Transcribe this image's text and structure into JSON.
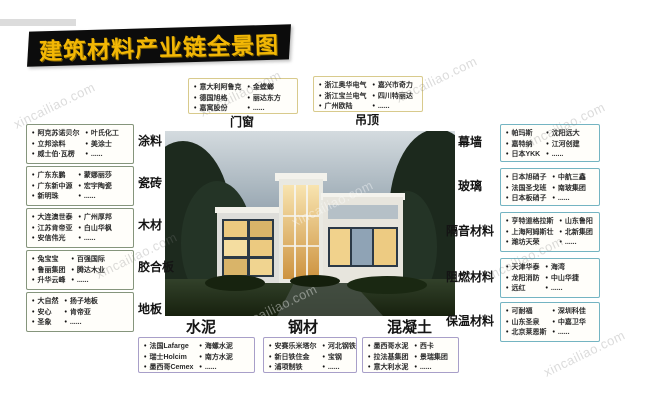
{
  "page": {
    "title": "建筑材料产业链全景图",
    "watermark": "xincailiao.com",
    "colors": {
      "banner_bg": "#0c0c0c",
      "banner_text": "#f2b705",
      "border_top_boxes": "#d8ca8c",
      "border_left_boxes": "#85957c",
      "border_right_boxes": "#74b4c2",
      "border_bottom_boxes": "#a89fc9"
    }
  },
  "boxes": [
    {
      "id": "menchuang",
      "label": "门窗",
      "col1": [
        "意大利阿鲁克",
        "德国旭格",
        "嘉寓股份"
      ],
      "col2": [
        "金螳螂",
        "丽达东方",
        "......"
      ]
    },
    {
      "id": "diaoding",
      "label": "吊顶",
      "col1": [
        "浙江奥华电气",
        "浙江宝兰电气",
        "广州欧陆"
      ],
      "col2": [
        "嘉兴市奇力",
        "四川特丽达",
        "......"
      ]
    },
    {
      "id": "tuliao",
      "label": "涂料",
      "col1": [
        "阿克苏诺贝尔",
        "立邦涂料",
        "威士伯·瓦楞"
      ],
      "col2": [
        "叶氏化工",
        "美涂士",
        "......"
      ]
    },
    {
      "id": "cizhuan",
      "label": "瓷砖",
      "col1": [
        "广东东鹏",
        "广东新中源",
        "新明珠"
      ],
      "col2": [
        "蒙娜丽莎",
        "宏宇陶瓷",
        "......"
      ]
    },
    {
      "id": "mucai",
      "label": "木材",
      "col1": [
        "大连澳世泰",
        "江苏肯帝亚",
        "安信伟光"
      ],
      "col2": [
        "广州厚邦",
        "白山华枫",
        "......"
      ]
    },
    {
      "id": "jiaoheban",
      "label": "胶合板",
      "col1": [
        "兔宝宝",
        "鲁丽集团",
        "升华云峰"
      ],
      "col2": [
        "百强国际",
        "腾达木业",
        "......"
      ]
    },
    {
      "id": "diban",
      "label": "地板",
      "col1": [
        "大自然",
        "安心",
        "圣象"
      ],
      "col2": [
        "扬子地板",
        "肯帝亚",
        "......"
      ]
    },
    {
      "id": "muqiang",
      "label": "幕墙",
      "col1": [
        "帕玛斯",
        "嘉特纳",
        "日本YKK"
      ],
      "col2": [
        "沈阳远大",
        "江河创建",
        "......"
      ]
    },
    {
      "id": "boli",
      "label": "玻璃",
      "col1": [
        "日本旭硝子",
        "法国圣戈班",
        "日本板硝子"
      ],
      "col2": [
        "中航三鑫",
        "南玻集团",
        "......"
      ]
    },
    {
      "id": "geyin",
      "label": "隔音材料",
      "col1": [
        "亨特道格拉斯",
        "上海阿姆斯壮",
        "潍坊天荣"
      ],
      "col2": [
        "山东鲁阳",
        "北新集团",
        "......"
      ]
    },
    {
      "id": "zuran",
      "label": "阻燃材料",
      "col1": [
        "天津华泰",
        "龙阳消防",
        "远红"
      ],
      "col2": [
        "海湾",
        "中山华捷",
        "......"
      ]
    },
    {
      "id": "baowen",
      "label": "保温材料",
      "col1": [
        "可耐福",
        "山东圣泉",
        "北京莱恩斯"
      ],
      "col2": [
        "深圳科佳",
        "中嘉卫华",
        "......"
      ]
    },
    {
      "id": "shuini",
      "label": "水泥",
      "col1": [
        "法国Lafarge",
        "瑞士Holcim",
        "墨西哥Cemex"
      ],
      "col2": [
        "海螺水泥",
        "南方水泥",
        "......"
      ]
    },
    {
      "id": "gangcai",
      "label": "钢材",
      "col1": [
        "安赛乐米塔尔",
        "新日铁住金",
        "浦项制铁"
      ],
      "col2": [
        "河北钢铁",
        "宝钢",
        "......"
      ]
    },
    {
      "id": "hunningtu",
      "label": "混凝土",
      "col1": [
        "墨西哥水泥",
        "拉法基集团",
        "意大利水泥"
      ],
      "col2": [
        "西卡",
        "景瑞集团",
        "......"
      ]
    }
  ]
}
